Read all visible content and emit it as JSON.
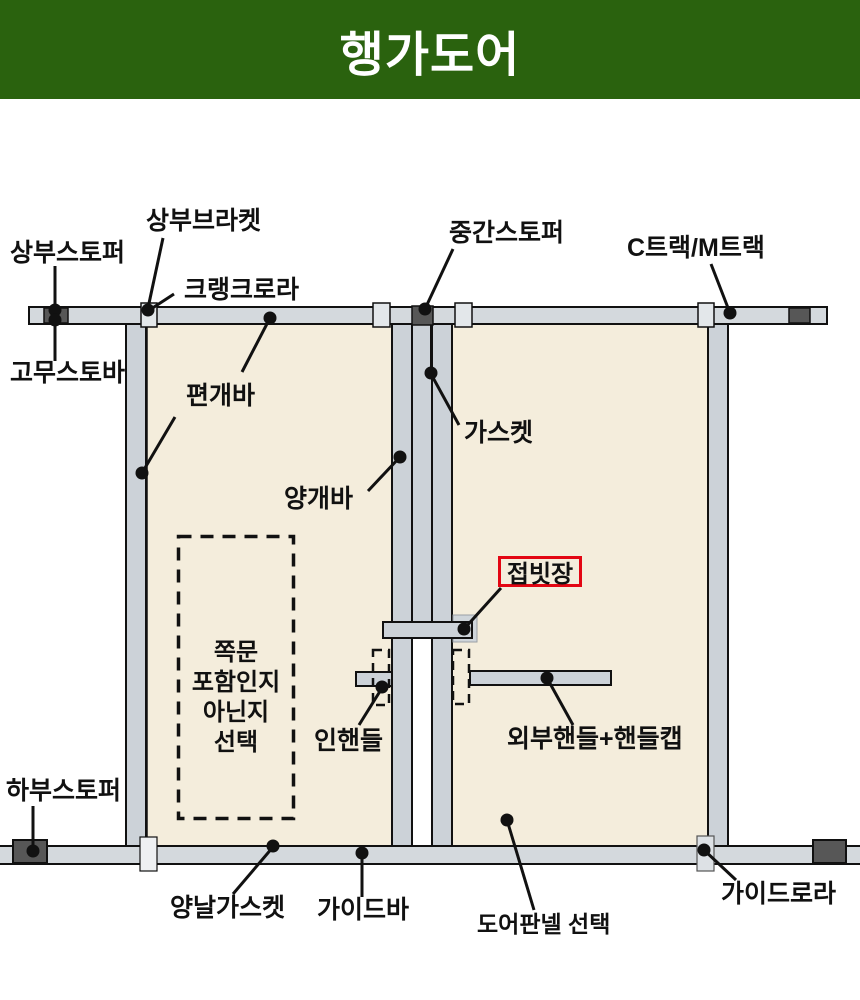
{
  "header": {
    "title": "행가도어"
  },
  "diagram": {
    "labels": {
      "top_stopper": "상부스토퍼",
      "top_bracket": "상부브라켓",
      "crank_roller": "크랭크로라",
      "middle_stopper": "중간스토퍼",
      "track_type": "C트랙/M트랙",
      "rubber_stopper": "고무스토바",
      "single_swing_bar": "편개바",
      "gasket": "가스켓",
      "double_swing_bar": "양개바",
      "folding_latch": "접빗장",
      "inner_handle": "인핸들",
      "outer_handle": "외부핸들+핸들캡",
      "bottom_stopper": "하부스토퍼",
      "double_edge_gasket": "양날가스켓",
      "guide_bar": "가이드바",
      "door_panel_select": "도어판넬 선택",
      "guide_roller": "가이드로라"
    },
    "side_door_note_lines": [
      "쪽문",
      "포함인지",
      "아닌지",
      "선택"
    ],
    "colors": {
      "banner_green": "#2a620e",
      "highlight_red": "#e30613",
      "panel_beige": "#f4eddc",
      "metal_gray": "#ccd2d8",
      "track_gray": "#d4d9dd",
      "stopper_dark_gray": "#575757"
    }
  }
}
